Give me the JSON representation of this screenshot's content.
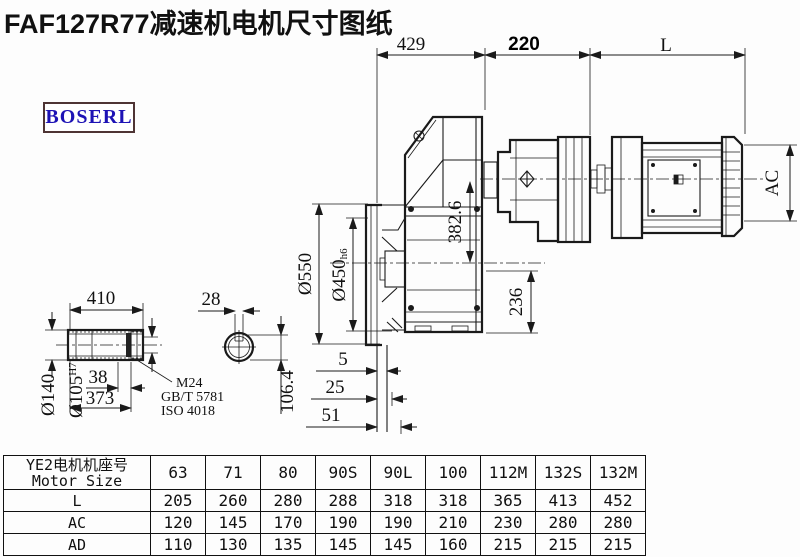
{
  "title": "FAF127R77减速机电机尺寸图纸",
  "logo": "BOSERL",
  "drawing": {
    "dims": {
      "top_left": "429",
      "top_mid": "220",
      "top_right": "L",
      "motor_height": "AC",
      "center_height": "382.6",
      "base_height": "236",
      "flange_od": "Ø550",
      "flange_spigot": "Ø450",
      "flange_spigot_tol": "h6",
      "offset_small": "5",
      "offset_mid": "25",
      "offset_large": "51",
      "shaft_len": "410",
      "shaft_od": "Ø140",
      "bore": "Ø105",
      "bore_tol": "H7",
      "end_gap": "38",
      "hub_len": "373",
      "key_width": "28",
      "key_height": "106.4",
      "bolt_spec_1": "M24",
      "bolt_spec_2": "GB/T 5781",
      "bolt_spec_3": "ISO 4018"
    }
  },
  "table": {
    "header_line1": "YE2电机机座号",
    "header_line2": "Motor Size",
    "columns": [
      "63",
      "71",
      "80",
      "90S",
      "90L",
      "100",
      "112M",
      "132S",
      "132M"
    ],
    "rows": [
      {
        "label": "L",
        "values": [
          "205",
          "260",
          "280",
          "288",
          "318",
          "318",
          "365",
          "413",
          "452"
        ]
      },
      {
        "label": "AC",
        "values": [
          "120",
          "145",
          "170",
          "190",
          "190",
          "210",
          "230",
          "280",
          "280"
        ]
      },
      {
        "label": "AD",
        "values": [
          "110",
          "130",
          "135",
          "145",
          "145",
          "160",
          "215",
          "215",
          "215"
        ]
      }
    ]
  },
  "colors": {
    "line": "#1a1a1a",
    "logo_text": "#1d12b5",
    "logo_border": "#4e3434"
  }
}
